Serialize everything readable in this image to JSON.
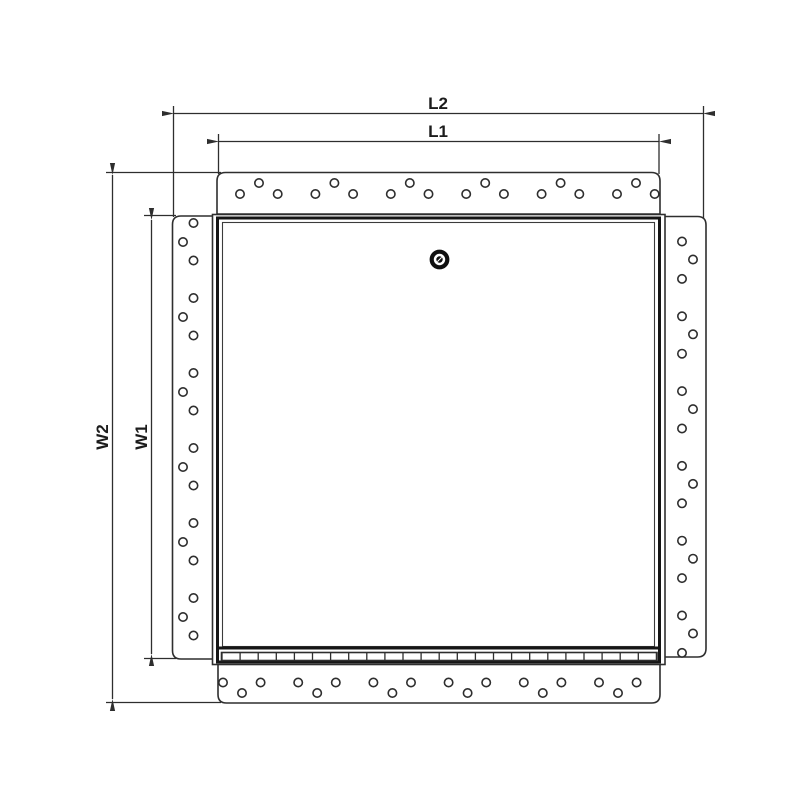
{
  "drawing": {
    "type": "technical-drawing",
    "subject": "flanged access panel, front view",
    "labels": {
      "l2": "L2",
      "l1": "L1",
      "w2": "W2",
      "w1": "W1"
    },
    "colors": {
      "line": "#2e2e2e",
      "door_edge": "#151515",
      "text": "#1c1c1c",
      "background": "#ffffff"
    },
    "mounting_holes": {
      "top_flange": 18,
      "bottom_flange": 18,
      "left_flange": 18,
      "right_flange": 18
    },
    "locks": 1
  }
}
